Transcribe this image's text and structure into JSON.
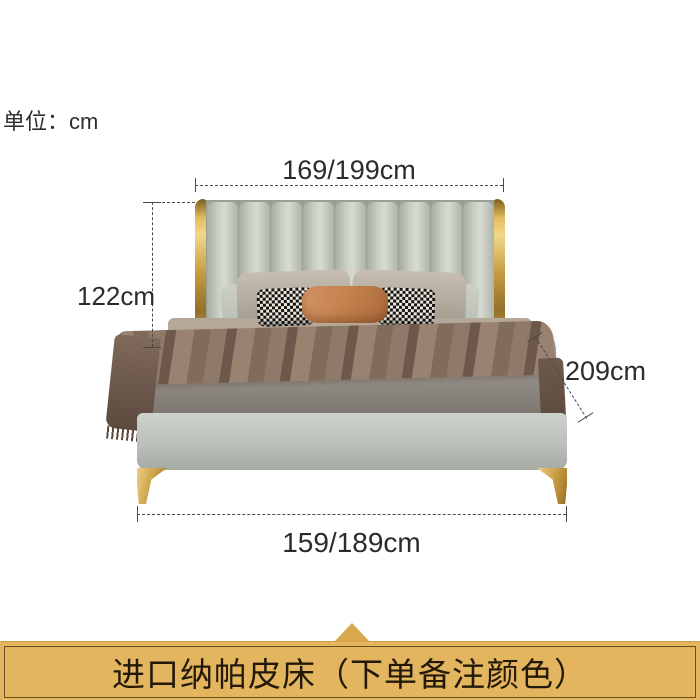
{
  "unit_label": "单位：cm",
  "dimensions": {
    "top": "169/199cm",
    "left": "122cm",
    "right": "209cm",
    "bottom": "159/189cm"
  },
  "banner": {
    "text": "进口纳帕皮床（下单备注颜色）"
  },
  "colors": {
    "accent_gold": "#c79b3f",
    "banner_background": "#e2b55e",
    "banner_border": "#6b4c1b",
    "leather_gray_green": "#c3c8bd",
    "blanket_brown": "#86705f",
    "lumbar_pillow_caramel": "#c5834f",
    "dimension_line": "#4a4a4a"
  }
}
